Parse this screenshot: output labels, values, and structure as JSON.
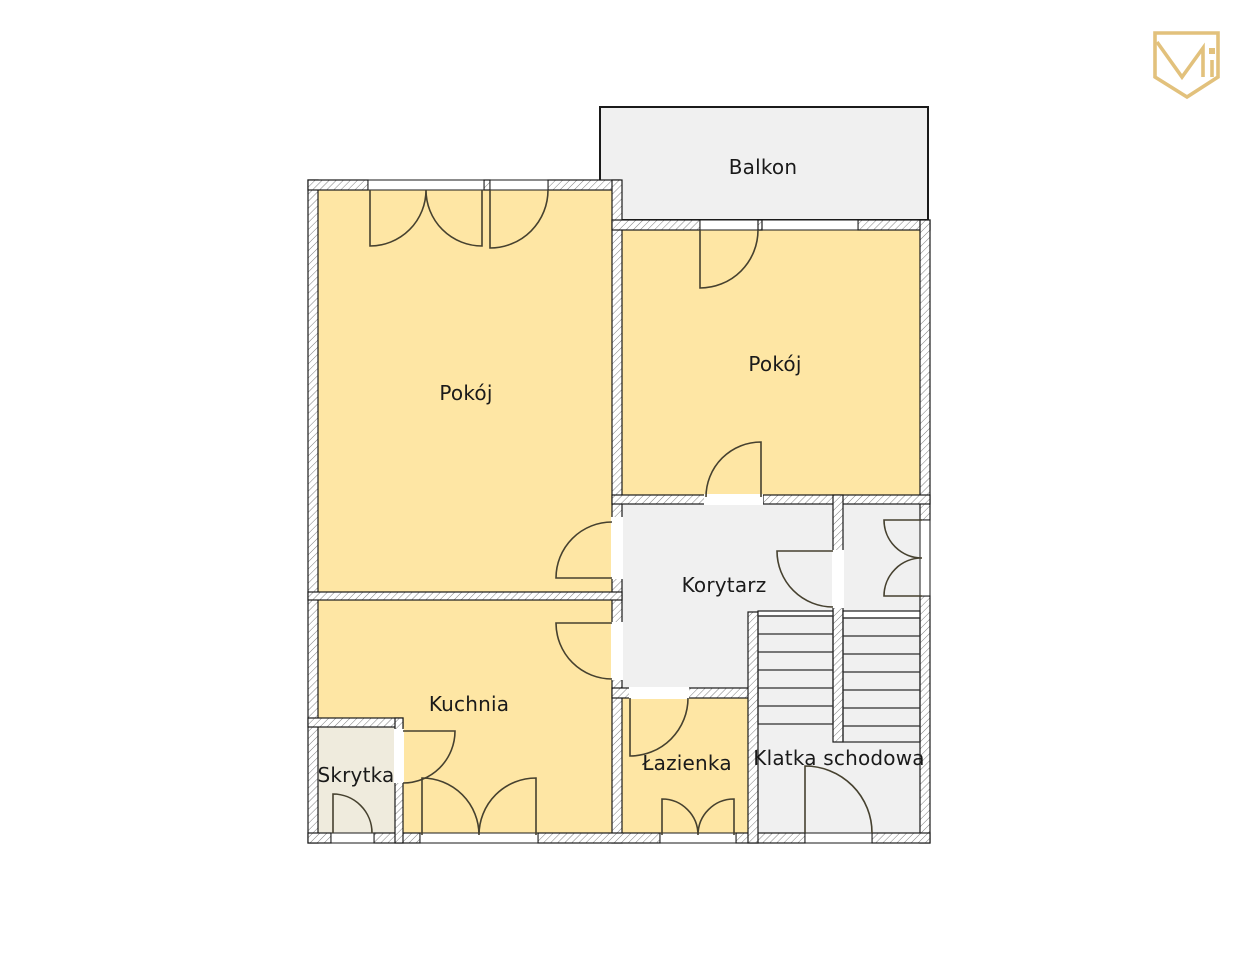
{
  "logo": {
    "name": "shield-monogram-icon",
    "color": "#e2c17c"
  },
  "colors": {
    "room_fill": "#fee6a4",
    "area_fill": "#f0f0f0",
    "storage_fill": "#efebdd",
    "wall_line": "#1a1a1a",
    "hatch_line": "#7d7d7d",
    "door_line": "#46412f",
    "stair_line": "#2e2e2e",
    "label_color": "#1a1a1a",
    "brand_gold": "#e2c17c"
  },
  "rooms": [
    {
      "id": "balkon",
      "label": "Balkon"
    },
    {
      "id": "pokoj_left",
      "label": "Pokój"
    },
    {
      "id": "pokoj_right",
      "label": "Pokój"
    },
    {
      "id": "korytarz",
      "label": "Korytarz"
    },
    {
      "id": "kuchnia",
      "label": "Kuchnia"
    },
    {
      "id": "skrytka",
      "label": "Skrytka"
    },
    {
      "id": "lazienka",
      "label": "Łazienka"
    },
    {
      "id": "klatka_schodowa",
      "label": "Klatka schodowa"
    }
  ]
}
